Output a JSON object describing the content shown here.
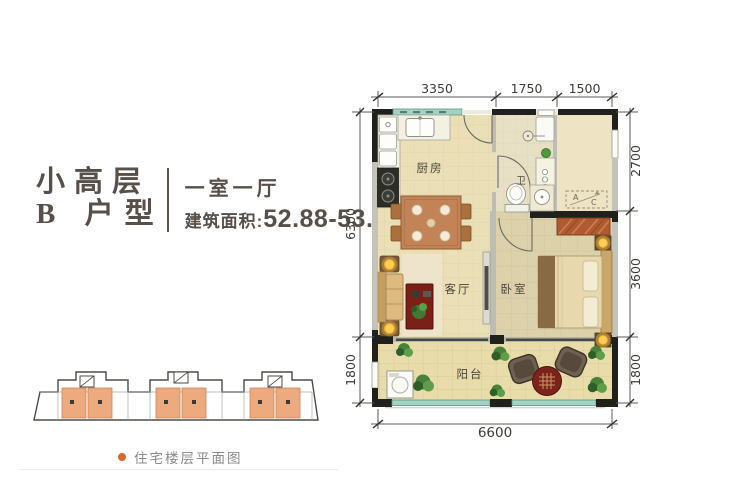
{
  "header": {
    "title_line1": "小高层",
    "title_line2": "B 户型",
    "subtitle": "一室一厅",
    "area_label": "建筑面积:",
    "area_value": "52.88-53.88m",
    "area_sup": "2"
  },
  "plan": {
    "rooms": {
      "kitchen": "厨房",
      "bath": "卫",
      "living": "客厅",
      "bedroom": "卧室",
      "balcony": "阳台"
    },
    "ac_platform": {
      "a": "A",
      "c": "C"
    },
    "dims": {
      "top": [
        "3350",
        "1750",
        "1500"
      ],
      "left": [
        "6300",
        "1800"
      ],
      "right": [
        "2700",
        "3600",
        "1800"
      ],
      "bottom": [
        "6600"
      ]
    }
  },
  "footer": {
    "caption": "住宅楼层平面图"
  },
  "colors": {
    "title_text": "#57504a",
    "caption_text": "#8a8a8a",
    "accent_orange": "#d9682a",
    "highlight_unit": "#ecaa7e",
    "floor_cream": "#ebdfb7",
    "bedroom_floor": "#dcd1aa",
    "balcony_floor": "#e8dcab",
    "wall_black": "#20201d",
    "window_teal": "#a3d2c3"
  }
}
